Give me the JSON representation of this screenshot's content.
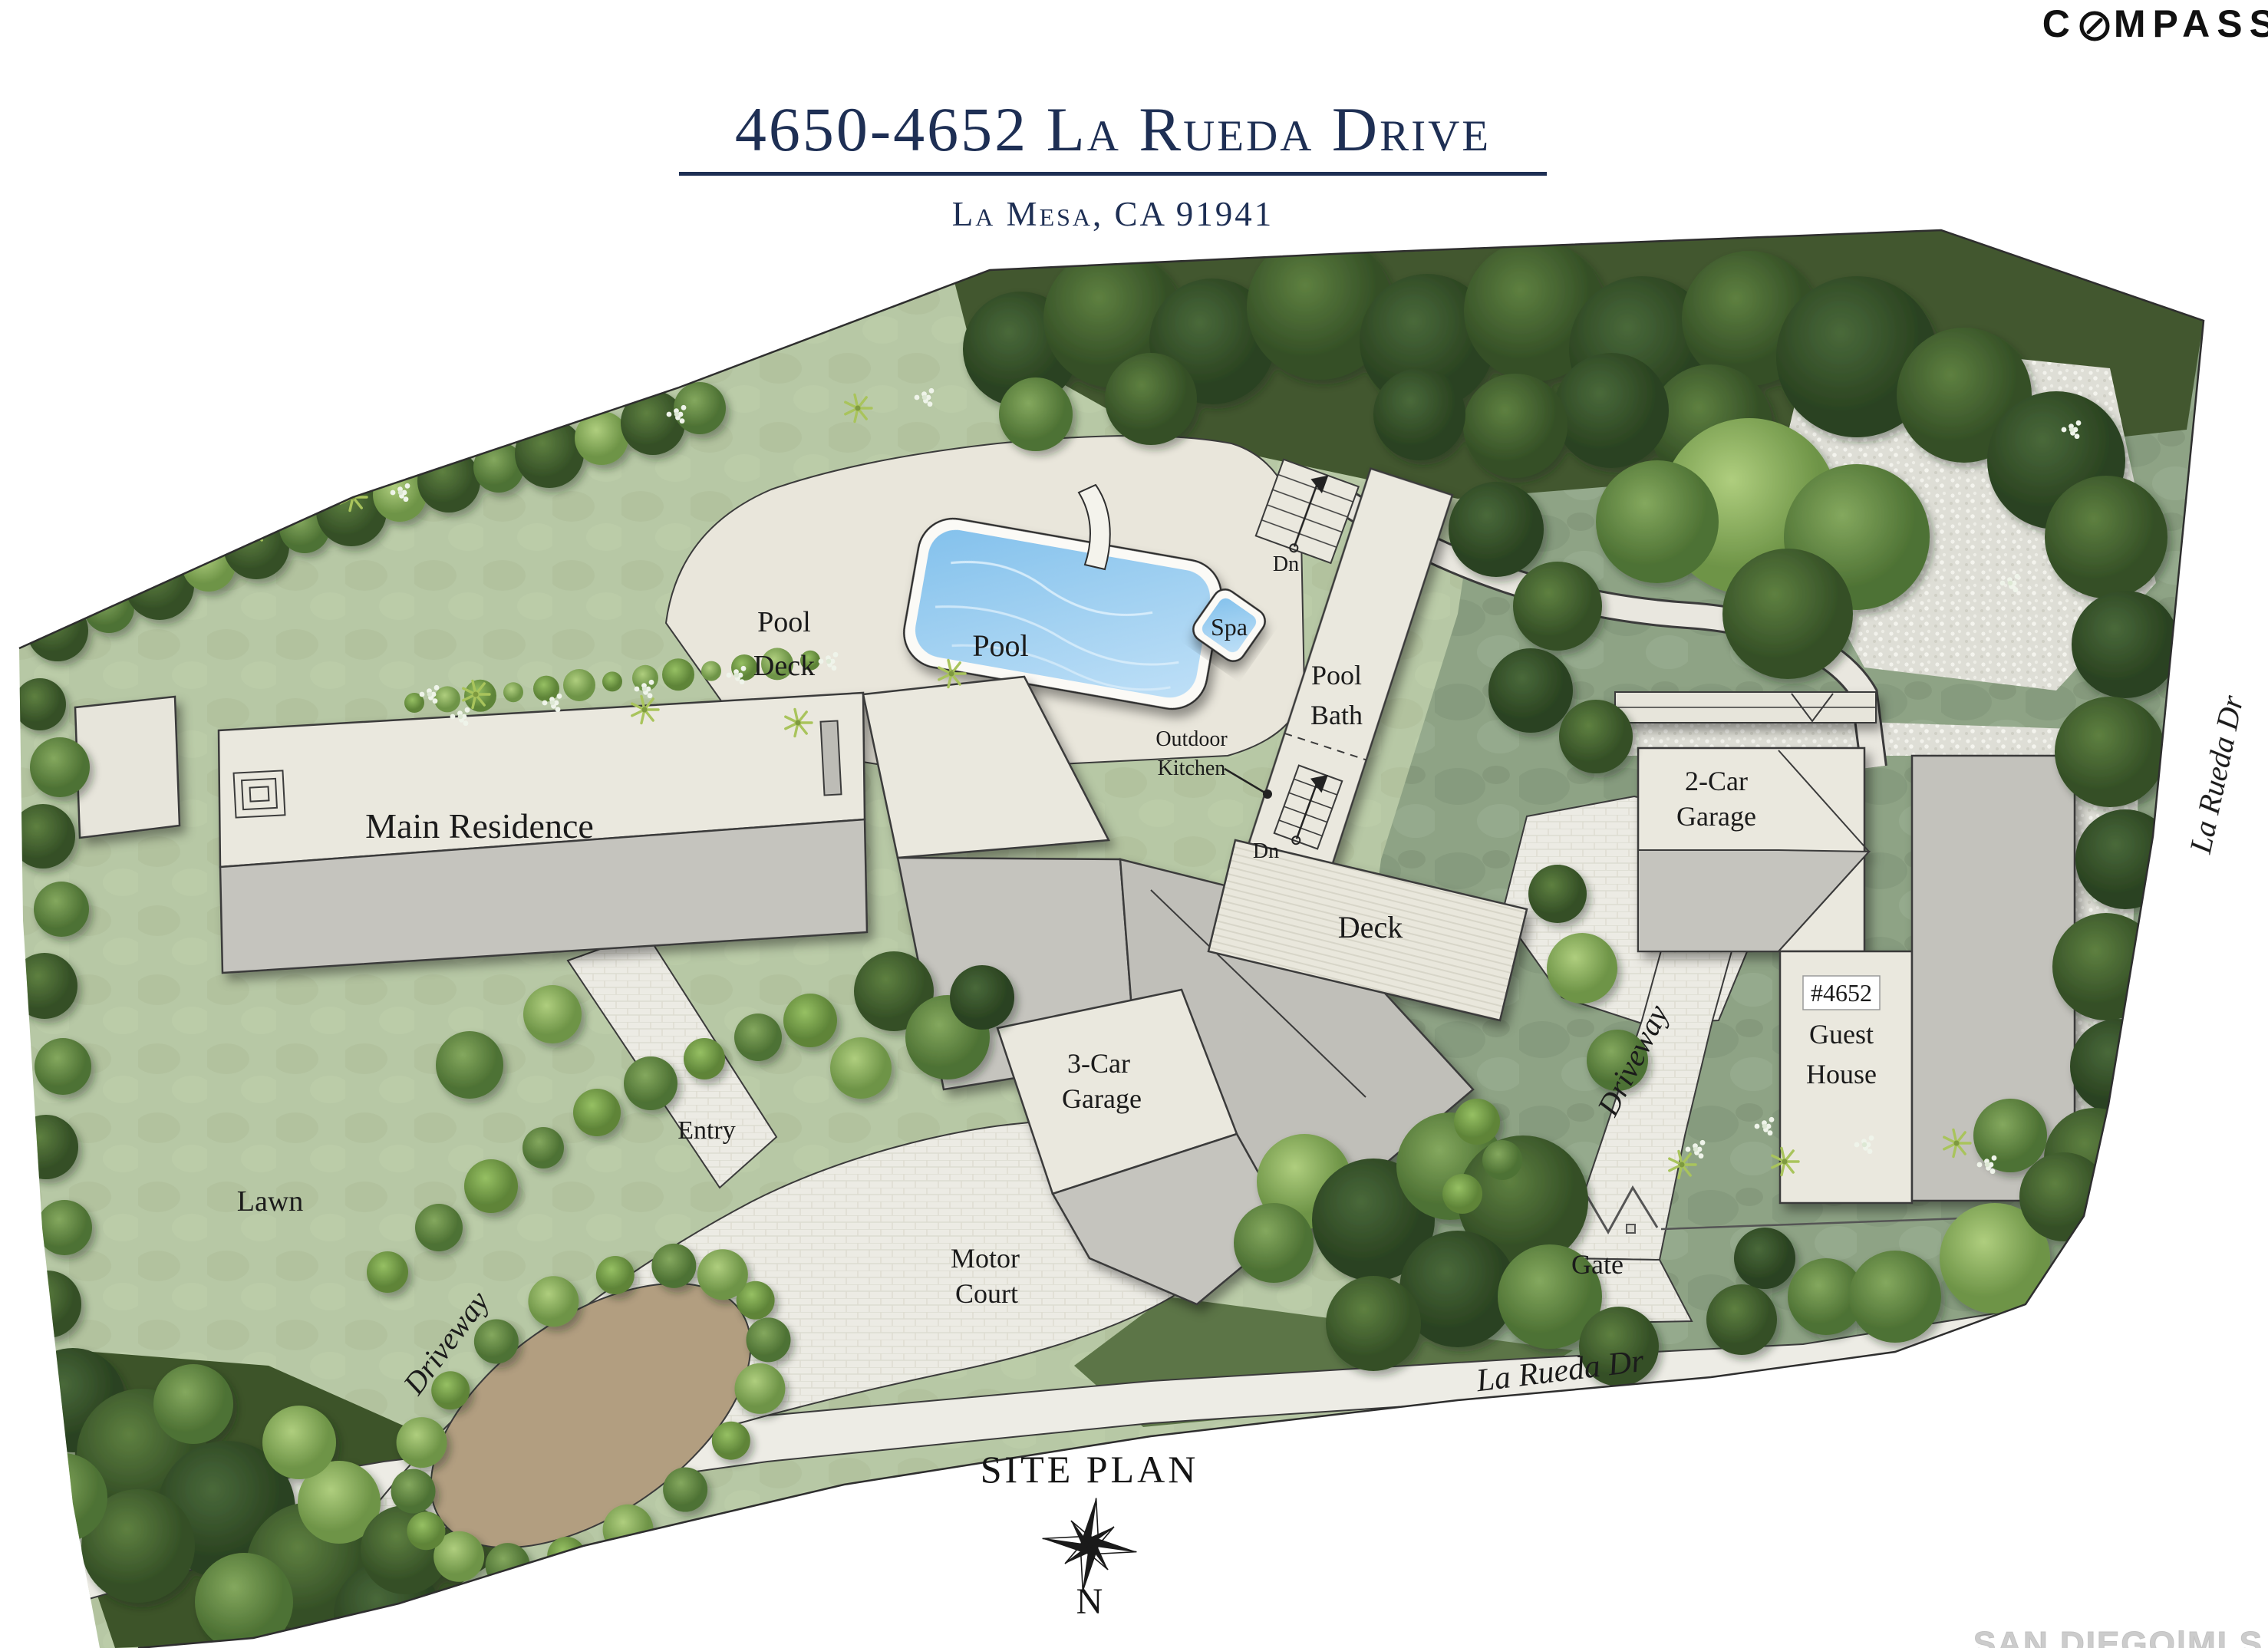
{
  "brand": {
    "logo_c": "C",
    "logo_rest": "MPASS"
  },
  "header": {
    "address": "4650-4652 La Rueda Drive",
    "city": "La Mesa, CA 91941"
  },
  "plan": {
    "labels": {
      "main_residence": "Main Residence",
      "pool_deck": [
        "Pool",
        "Deck"
      ],
      "pool": "Pool",
      "spa": "Spa",
      "down_upper": "Dn",
      "pool_bath": [
        "Pool",
        "Bath"
      ],
      "outdoor_kitchen": [
        "Outdoor",
        "Kitchen"
      ],
      "down_lower": "Dn",
      "deck": "Deck",
      "two_car_garage": [
        "2-Car",
        "Garage"
      ],
      "guest_house": [
        "#4652",
        "Guest",
        "House"
      ],
      "three_car_garage": [
        "3-Car",
        "Garage"
      ],
      "motor_court": [
        "Motor",
        "Court"
      ],
      "entry": "Entry",
      "lawn": "Lawn",
      "driveway_west": "Driveway",
      "driveway_east": "Driveway",
      "gate": "Gate",
      "street_bottom": "La Rueda Dr",
      "street_right": "La Rueda Dr"
    }
  },
  "footer": {
    "caption": "SITE PLAN",
    "north_label": "N",
    "watermark": "SAN DIEGO|MLS"
  },
  "colors": {
    "accent_navy": "#1E2F54",
    "pool_blue": "#8CC6EF",
    "lawn_green": "#B7C8A5",
    "tree_dark_green": "#3C5629",
    "hardscape": "#ECEBE4",
    "building_cream": "#EAE8DE",
    "roof_gray": "#C5C4BE",
    "logo_black": "#111111",
    "watermark_gray": "#CCCCCC"
  }
}
